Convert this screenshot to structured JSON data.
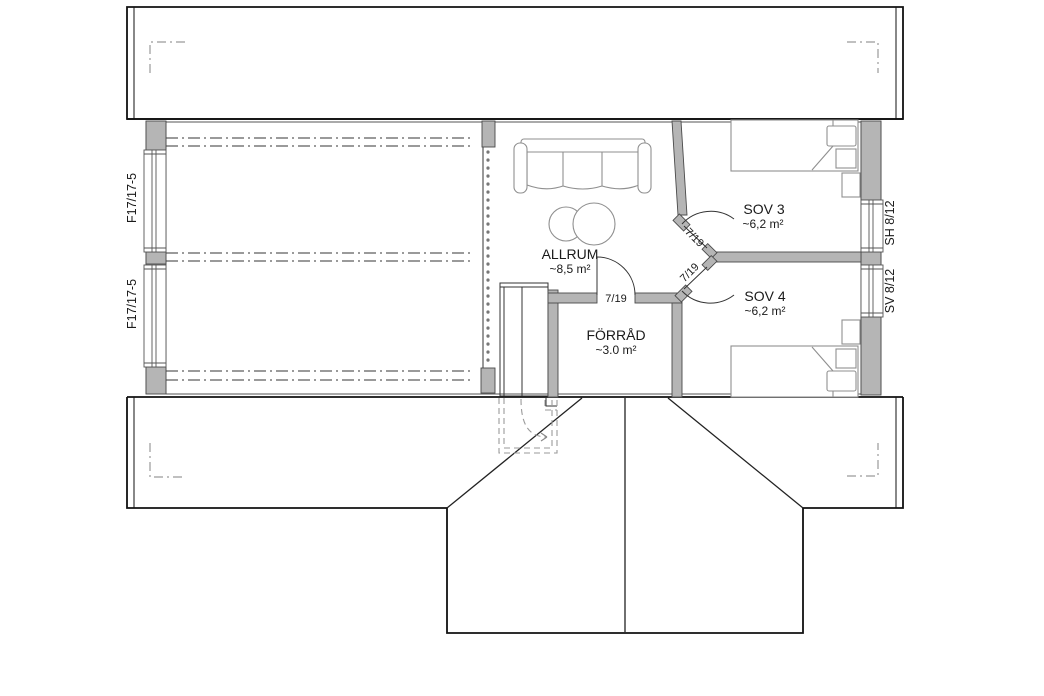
{
  "plan": {
    "rooms": [
      {
        "name": "ALLRUM",
        "area": "~8,5 m²"
      },
      {
        "name": "FÖRRÅD",
        "area": "~3.0 m²"
      },
      {
        "name": "SOV 3",
        "area": "~6,2 m²"
      },
      {
        "name": "SOV 4",
        "area": "~6,2 m²"
      }
    ],
    "windows": [
      {
        "label": "F17/17-5"
      },
      {
        "label": "F17/17-5"
      },
      {
        "label": "SH 8/12"
      },
      {
        "label": "SV 8/12"
      }
    ],
    "doors": [
      {
        "label": "7/19"
      },
      {
        "label": "7/19"
      },
      {
        "label": "7/19"
      }
    ],
    "colors": {
      "wall_fill": "#b5b5b5",
      "furniture": "#8f8f8f",
      "centerline": "#8c8c8c",
      "line": "#1a1a1a",
      "background": "#ffffff"
    }
  }
}
